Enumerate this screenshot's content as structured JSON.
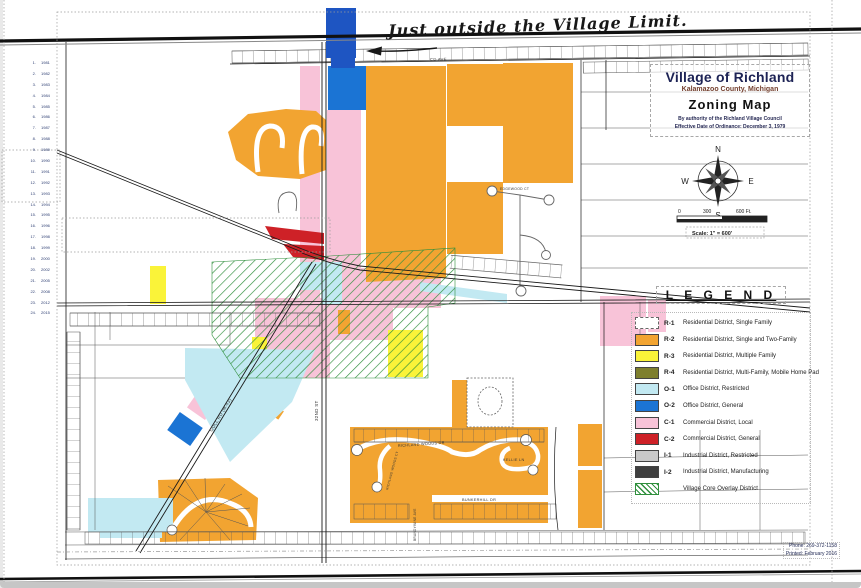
{
  "annotation": {
    "text": "Just outside the Village Limit."
  },
  "title_block": {
    "line1": "Village of Richland",
    "line2": "Kalamazoo County, Michigan",
    "line3": "Zoning Map",
    "line4": "By authority of the Richland Village Council",
    "line5": "Effective Date of Ordinance: December 3, 1979"
  },
  "compass": {
    "n": "N",
    "s": "S",
    "e": "E",
    "w": "W"
  },
  "scale_bar": {
    "tick0": "0",
    "tick300": "300",
    "tick600": "600 Ft.",
    "scale_text": "Scale: 1\" = 600'"
  },
  "legend": {
    "title": "L E G E N D",
    "items": [
      {
        "code": "R-1",
        "label": "Residential District, Single Family",
        "type": "outline",
        "color": "#ffffff"
      },
      {
        "code": "R-2",
        "label": "Residential District, Single and Two-Family",
        "type": "solid",
        "color": "#F2A431"
      },
      {
        "code": "R-3",
        "label": "Residential District, Multiple Family",
        "type": "solid",
        "color": "#FAF339"
      },
      {
        "code": "R-4",
        "label": "Residential District, Multi-Family, Mobile Home Pad",
        "type": "solid",
        "color": "#7E7F2D"
      },
      {
        "code": "O-1",
        "label": "Office District, Restricted",
        "type": "solid",
        "color": "#C2E9F2"
      },
      {
        "code": "O-2",
        "label": "Office District, General",
        "type": "solid",
        "color": "#1B74D4"
      },
      {
        "code": "C-1",
        "label": "Commercial District, Local",
        "type": "solid",
        "color": "#F8C3D8"
      },
      {
        "code": "C-2",
        "label": "Commercial District, General",
        "type": "solid",
        "color": "#CE2127"
      },
      {
        "code": "I-1",
        "label": "Industrial District, Restricted",
        "type": "solid",
        "color": "#C9C9C9"
      },
      {
        "code": "I-2",
        "label": "Industrial District, Manufacturing",
        "type": "solid",
        "color": "#3F3F3F"
      },
      {
        "code": "",
        "label": "Village Core Overlay District",
        "type": "hatch",
        "color": "#2F8F3C"
      }
    ]
  },
  "streets": {
    "cd_ave": "CD AVE",
    "thirty_second": "32ND ST",
    "gull_rd": "GULL RD (M-43)",
    "richland_woods_dr": "RICHLAND WOODS DR",
    "richland_woods_ct": "RICHLAND WOODS CT",
    "kellie_ln": "KELLIE LN",
    "bunkerhill_dr": "BUNKERHILL DR",
    "edgewood_ct": "EDGEWOOD CT",
    "brandywine": "BRANDYWINE AVE"
  },
  "amendments": {
    "entries": [
      {
        "num": "1.",
        "year": "1981"
      },
      {
        "num": "2.",
        "year": "1982"
      },
      {
        "num": "3.",
        "year": "1983"
      },
      {
        "num": "4.",
        "year": "1984"
      },
      {
        "num": "5.",
        "year": "1985"
      },
      {
        "num": "6.",
        "year": "1986"
      },
      {
        "num": "7.",
        "year": "1987"
      },
      {
        "num": "8.",
        "year": "1988"
      },
      {
        "num": "9.",
        "year": "1989"
      },
      {
        "num": "10.",
        "year": "1990"
      },
      {
        "num": "11.",
        "year": "1991"
      },
      {
        "num": "12.",
        "year": "1992"
      },
      {
        "num": "13.",
        "year": "1993"
      },
      {
        "num": "14.",
        "year": "1994"
      },
      {
        "num": "15.",
        "year": "1995"
      },
      {
        "num": "16.",
        "year": "1996"
      },
      {
        "num": "17.",
        "year": "1998"
      },
      {
        "num": "18.",
        "year": "1999"
      },
      {
        "num": "19.",
        "year": "2000"
      },
      {
        "num": "20.",
        "year": "2002"
      },
      {
        "num": "21.",
        "year": "2005"
      },
      {
        "num": "22.",
        "year": "2008"
      },
      {
        "num": "23.",
        "year": "2012"
      },
      {
        "num": "24.",
        "year": "2015"
      }
    ]
  },
  "footer": {
    "phone": "Phone: 269-372-1158",
    "printed": "Printed: February 2016"
  },
  "colors": {
    "orange": "#F2A431",
    "yellow": "#FAF339",
    "olive": "#7E7F2D",
    "lightblue": "#C2E9F2",
    "blue": "#1B74D4",
    "navy": "#1E55C2",
    "pink": "#F8C3D8",
    "red": "#CE2127",
    "lightgray": "#C9C9C9",
    "darkgray": "#3F3F3F",
    "green": "#2F8F3C"
  }
}
